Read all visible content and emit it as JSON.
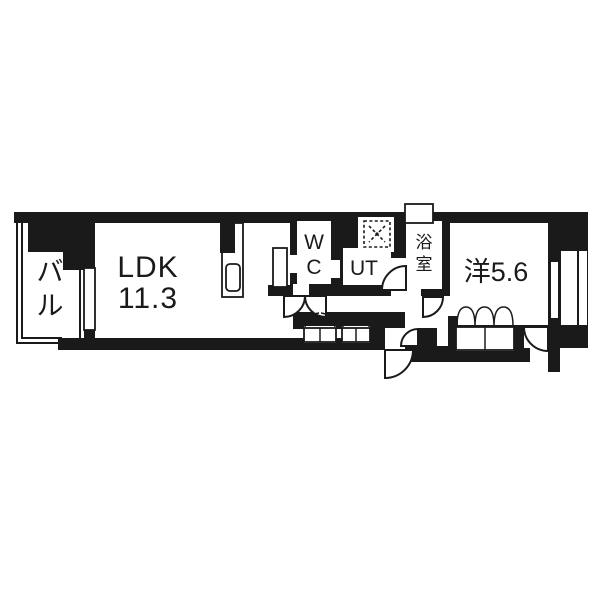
{
  "floorplan": {
    "type": "apartment-floor-plan",
    "colors": {
      "wall": "#1a1a1a",
      "floor": "#ffffff"
    },
    "rooms": {
      "balcony": {
        "label": "バル",
        "chars": [
          "バ",
          "ル"
        ]
      },
      "ldk": {
        "label": "LDK 11.3",
        "line1": "LDK",
        "line2": "11.3",
        "area_tatami": "11.3"
      },
      "wc": {
        "label": "WC",
        "chars": [
          "W",
          "C"
        ]
      },
      "ut": {
        "label": "UT"
      },
      "bath": {
        "label": "浴室",
        "chars": [
          "浴",
          "室"
        ]
      },
      "western": {
        "label": "洋5.6",
        "area_tatami": "5.6"
      }
    },
    "symbols": [
      "kitchen-sink",
      "washing-machine-dashed-square",
      "hinged-door-arcs",
      "double-leaf-closet-doors",
      "balcony-railing"
    ]
  }
}
